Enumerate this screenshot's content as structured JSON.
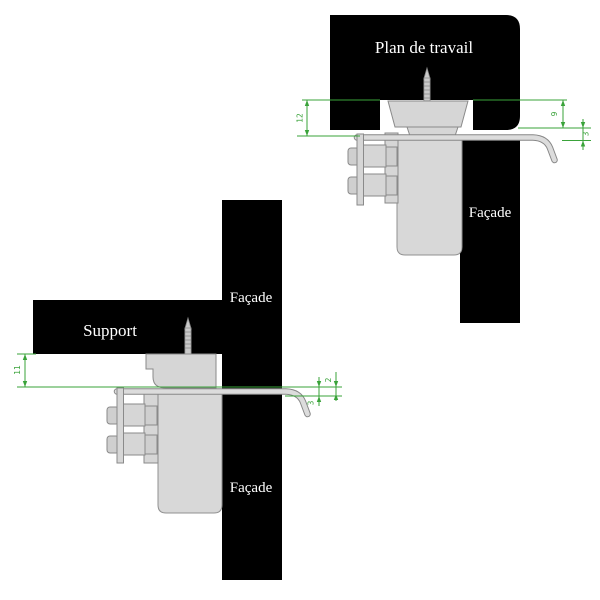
{
  "colors": {
    "background": "#ffffff",
    "panel_black": "#000000",
    "panel_text": "#ffffff",
    "metal_light": "#d6d6d6",
    "metal_stroke": "#8a8a8a",
    "dimension_green": "#3aa33a"
  },
  "top_diagram": {
    "worktop_label": "Plan de travail",
    "facade_label": "Façade",
    "dimensions": {
      "left": "12",
      "inner_right": "9",
      "outer_right": "3"
    }
  },
  "bottom_diagram": {
    "support_label": "Support",
    "facade_label_upper": "Façade",
    "facade_label_lower": "Façade",
    "dimensions": {
      "left": "11",
      "inner_right": "3",
      "outer_right": "2"
    }
  }
}
